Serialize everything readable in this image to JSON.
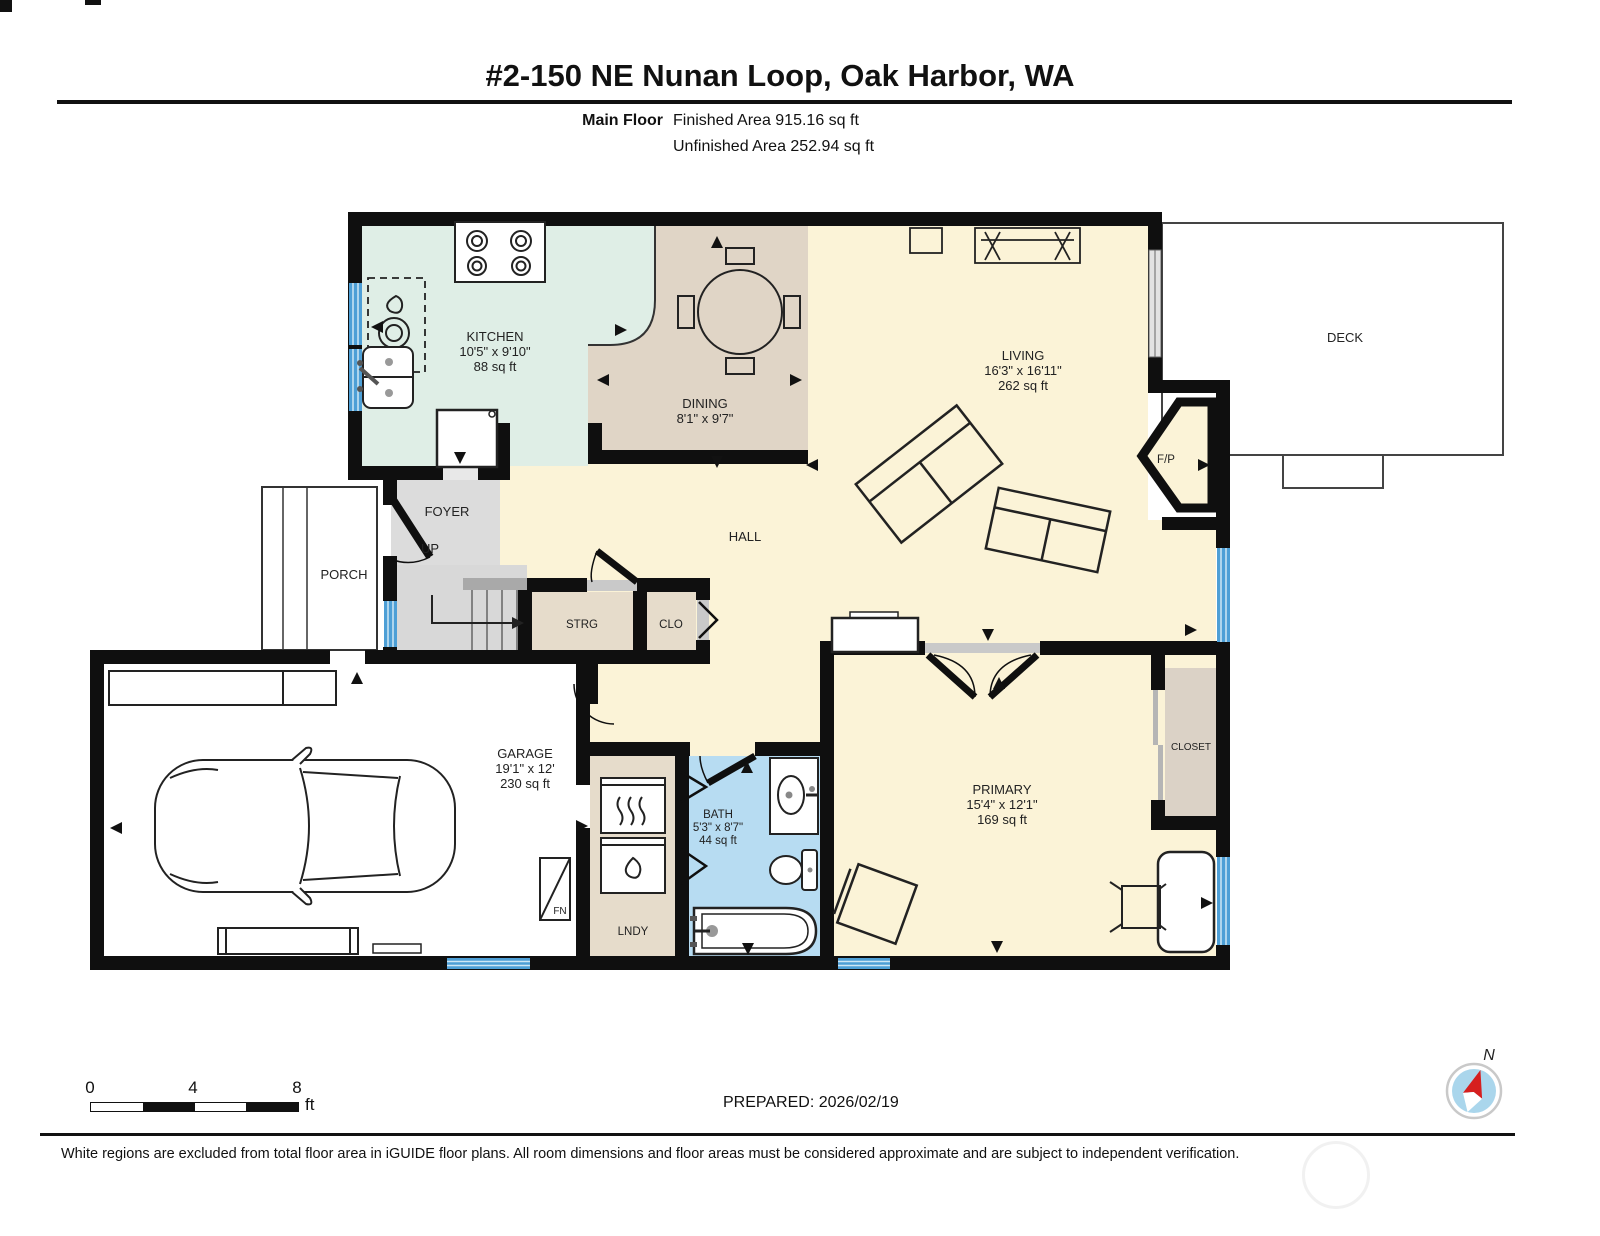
{
  "header": {
    "title": "#2-150 NE Nunan Loop, Oak Harbor, WA",
    "floor_label": "Main Floor",
    "finished_area": "Finished Area 915.16 sq ft",
    "unfinished_area": "Unfinished Area 252.94 sq ft"
  },
  "rooms": {
    "kitchen": {
      "name": "KITCHEN",
      "dims": "10'5\" x 9'10\"",
      "area": "88 sq ft"
    },
    "dining": {
      "name": "DINING",
      "dims": "8'1\" x 9'7\""
    },
    "living": {
      "name": "LIVING",
      "dims": "16'3\" x 16'11\"",
      "area": "262 sq ft"
    },
    "deck": {
      "name": "DECK"
    },
    "porch": {
      "name": "PORCH"
    },
    "foyer": {
      "name": "FOYER",
      "up": "UP"
    },
    "hall": {
      "name": "HALL"
    },
    "strg": {
      "name": "STRG"
    },
    "clo": {
      "name": "CLO"
    },
    "garage": {
      "name": "GARAGE",
      "dims": "19'1\" x 12'",
      "area": "230 sq ft"
    },
    "furnace": {
      "name": "FN"
    },
    "lndy": {
      "name": "LNDY"
    },
    "bath": {
      "name": "BATH",
      "dims": "5'3\" x 8'7\"",
      "area": "44 sq ft"
    },
    "primary": {
      "name": "PRIMARY",
      "dims": "15'4\" x 12'1\"",
      "area": "169 sq ft"
    },
    "closet": {
      "name": "CLOSET"
    },
    "fireplace": {
      "name": "F/P"
    }
  },
  "scale_bar": {
    "tick0": "0",
    "tick4": "4",
    "tick8": "8",
    "unit": "ft"
  },
  "prepared": "PREPARED: 2026/02/19",
  "compass": {
    "north": "N"
  },
  "footer": {
    "disclaimer": "White regions are excluded from total floor area in iGUIDE floor plans. All room dimensions and floor areas must be considered approximate and are subject to independent verification."
  },
  "colors": {
    "wall": "#0f0f0f",
    "cream": "#fbf3d7",
    "mint": "#dfeee6",
    "dining_tan": "#e0d5c6",
    "storage_tan": "#e6dccb",
    "closet_tan": "#dbd2c6",
    "bath_blue": "#b7dcf2",
    "window_blue": "#4d9fd6",
    "foyer_gray": "#dcdcdc",
    "north_red": "#d61f1f"
  }
}
